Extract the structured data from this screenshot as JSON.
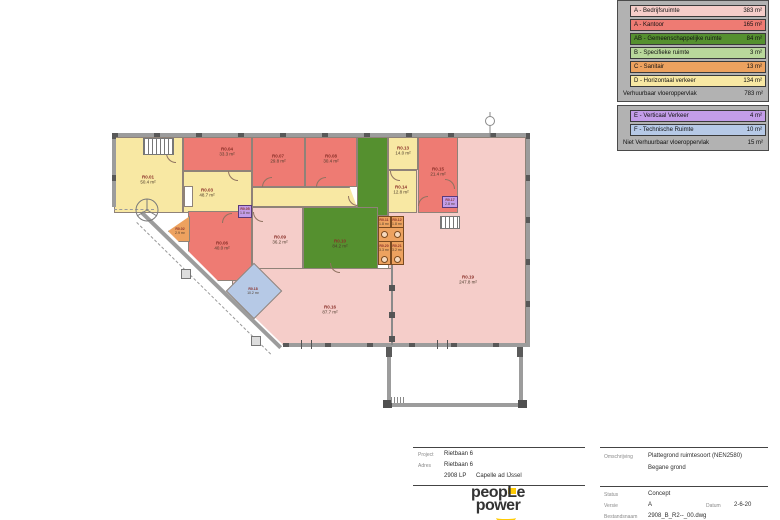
{
  "colors": {
    "bedrijfsruimte": "#f5cdc9",
    "kantoor": "#ee7b73",
    "gemeenschappelijk": "#55902f",
    "specifiek": "#b9d89b",
    "sanitair": "#eda25f",
    "verkeer": "#f8e8a3",
    "verticaal": "#c39de8",
    "techniek": "#b6c9e6",
    "grayrow": "#b2b2b2"
  },
  "legend": {
    "rows": [
      {
        "label": "A - Bedrijfsruimte",
        "area": "383 m²",
        "color": "#f5cdc9"
      },
      {
        "label": "A - Kantoor",
        "area": "165 m²",
        "color": "#ee7b73"
      },
      {
        "label": "AB - Gemeenschappelijke ruimte",
        "area": "84 m²",
        "color": "#55902f"
      },
      {
        "label": "B - Specifieke ruimte",
        "area": "3 m²",
        "color": "#b9d89b"
      },
      {
        "label": "C - Sanitair",
        "area": "13 m²",
        "color": "#eda25f"
      },
      {
        "label": "D - Horizontaal verkeer",
        "area": "134 m²",
        "color": "#f8e8a3"
      }
    ],
    "subtotal": {
      "label": "Verhuurbaar vloeroppervlak",
      "area": "783 m²"
    },
    "rows2": [
      {
        "label": "E - Verticaal Verkeer",
        "area": "4 m²",
        "color": "#c39de8"
      },
      {
        "label": "F - Technische Ruimte",
        "area": "10 m²",
        "color": "#b6c9e6"
      }
    ],
    "total": {
      "label": "Niet Verhuurbaar vloeroppervlak",
      "area": "15 m²"
    }
  },
  "plan": {
    "rooms": [
      {
        "id": "R0.01",
        "area": "50.4 m²"
      },
      {
        "id": "R0.02",
        "area": "2.9 m²"
      },
      {
        "id": "R0.03",
        "area": "48.7 m²"
      },
      {
        "id": "R0.04",
        "area": "33.3 m²"
      },
      {
        "id": "R0.05",
        "area": "1.8 m²"
      },
      {
        "id": "R0.06",
        "area": "40.0 m²"
      },
      {
        "id": "R0.07",
        "area": "29.8 m²"
      },
      {
        "id": "R0.08",
        "area": "30.4 m²"
      },
      {
        "id": "R0.09",
        "area": "36.2 m²"
      },
      {
        "id": "R0.10",
        "area": "84.2 m²"
      },
      {
        "id": "R0.11",
        "area": "1.8 m²"
      },
      {
        "id": "R0.12",
        "area": "1.8 m²"
      },
      {
        "id": "R0.13",
        "area": "14.0 m²"
      },
      {
        "id": "R0.14",
        "area": "12.8 m²"
      },
      {
        "id": "R0.15",
        "area": "21.4 m²"
      },
      {
        "id": "R0.16",
        "area": "87.7 m²"
      },
      {
        "id": "R0.17",
        "area": "2.8 m²"
      },
      {
        "id": "R0.18",
        "area": "10.2 m²"
      },
      {
        "id": "R0.19",
        "area": "247.8 m²"
      },
      {
        "id": "R0.20",
        "area": "3.3 m²"
      },
      {
        "id": "R0.21",
        "area": "3.2 m²"
      }
    ]
  },
  "titleblock": {
    "left": {
      "project_label": "Project",
      "project": "Rietbaan 6",
      "adres_label": "Adres",
      "adres": "Rietbaan 6",
      "postcode": "2908 LP",
      "plaats": "Capelle ad IJssel"
    },
    "right": {
      "omschrijving_label": "Omschrijving",
      "omschrijving": "Plattegrond ruimtesoort (NEN2580)",
      "subtitle": "Begane grond",
      "status_label": "Status",
      "status": "Concept",
      "versie_label": "Versie",
      "versie": "A",
      "datum_label": "Datum",
      "datum": "2-6-20",
      "bestand_label": "Bestandsnaam",
      "bestand": "2908_B_R2--_00.dwg"
    },
    "logo": {
      "line1": "peopLe",
      "line2": "power"
    }
  }
}
